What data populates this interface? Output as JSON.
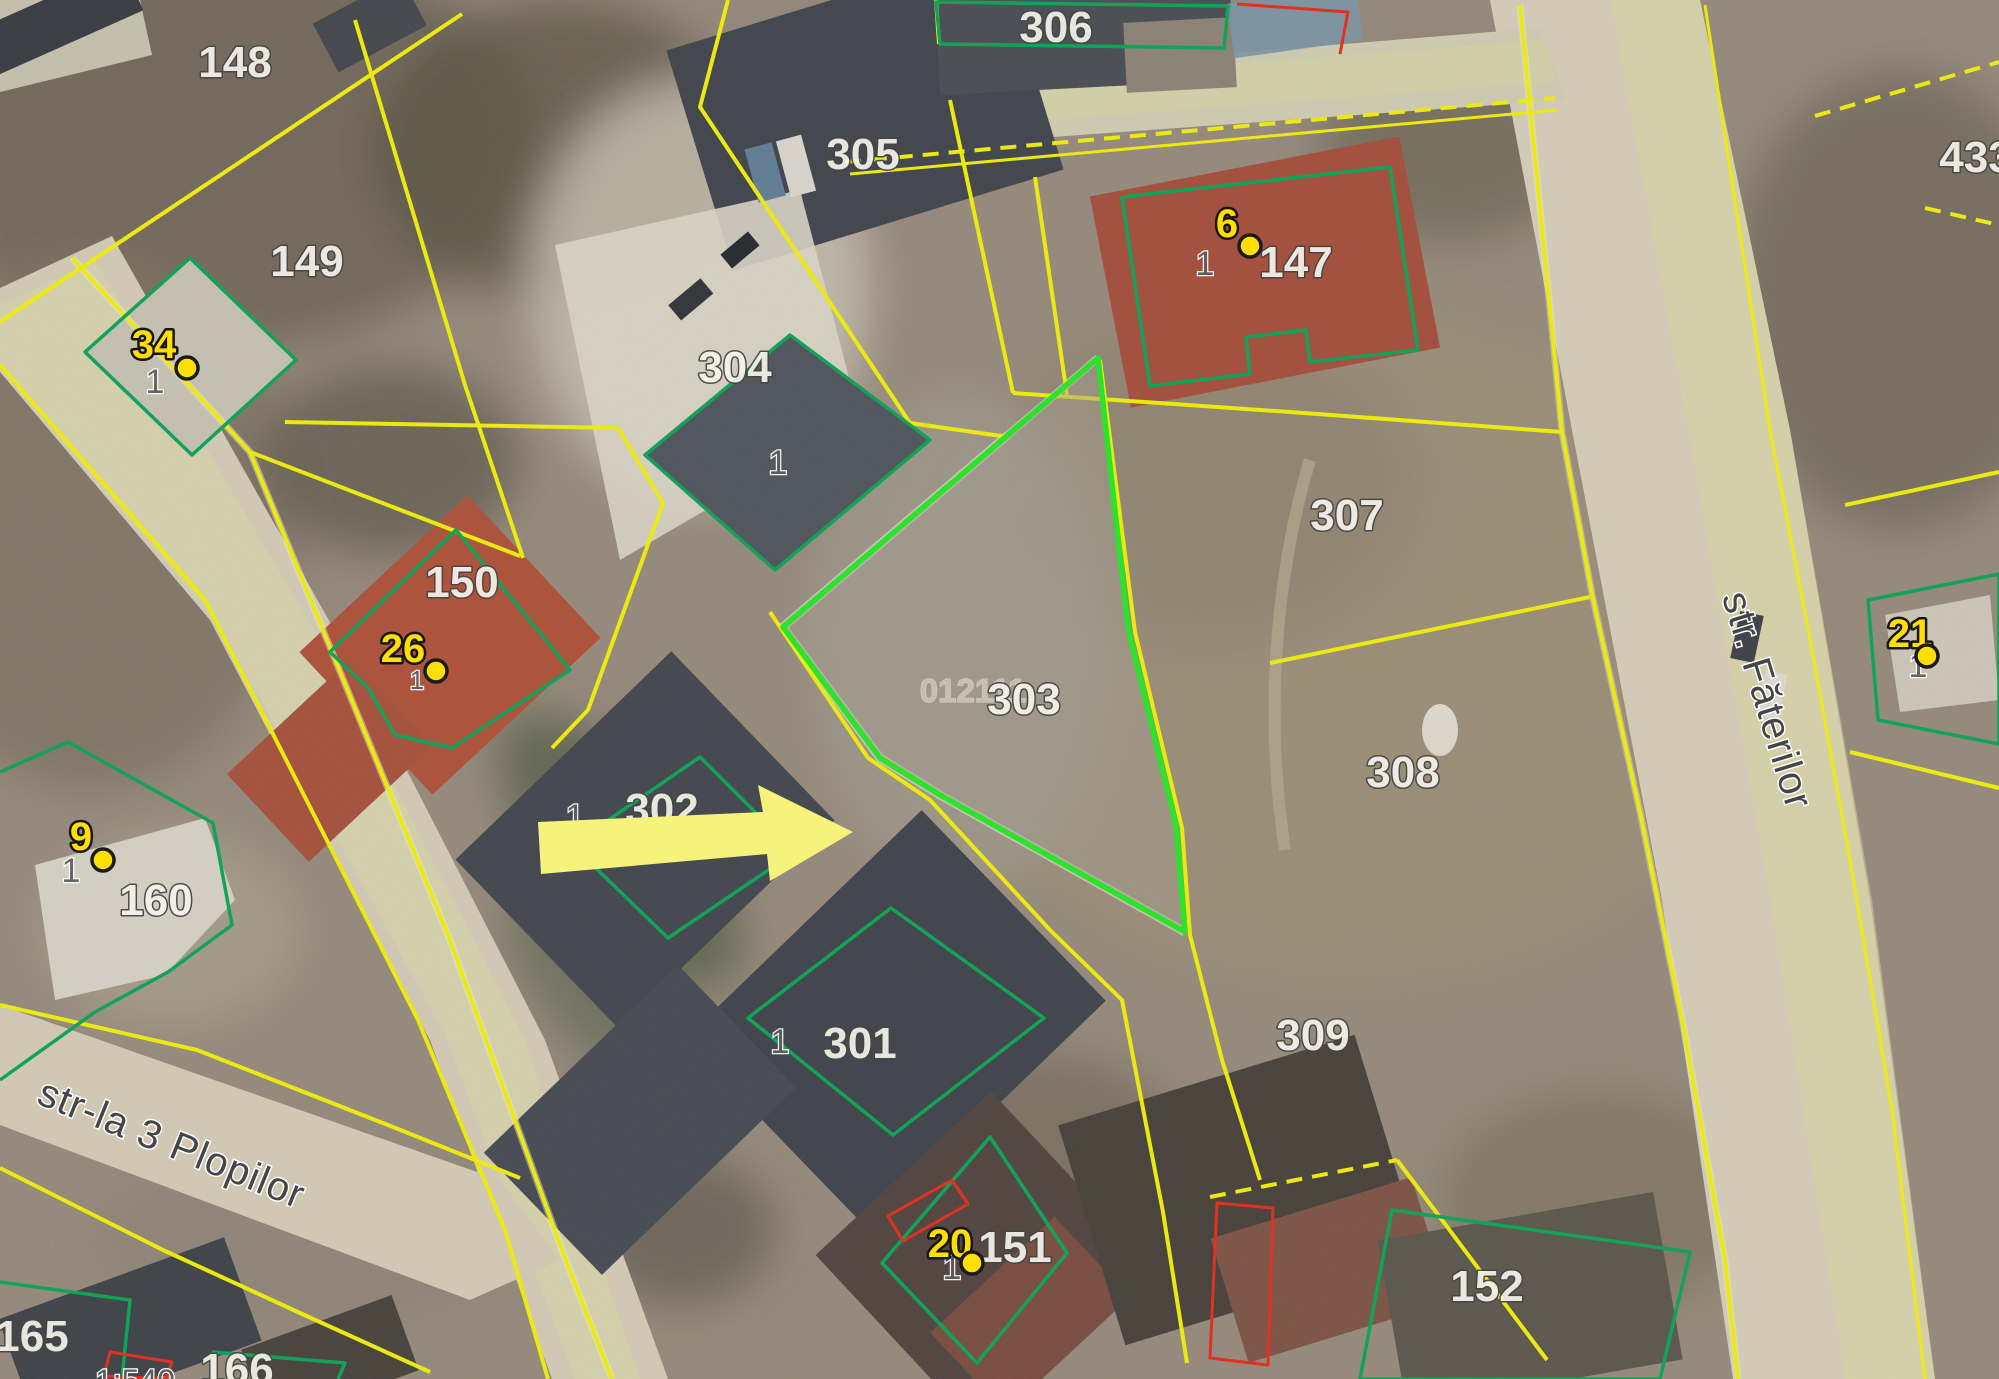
{
  "map": {
    "parcel_labels": [
      {
        "text": "148"
      },
      {
        "text": "149"
      },
      {
        "text": "305"
      },
      {
        "text": "304"
      },
      {
        "text": "306"
      },
      {
        "text": "147"
      },
      {
        "text": "303"
      },
      {
        "text": "307"
      },
      {
        "text": "308"
      },
      {
        "text": "150"
      },
      {
        "text": "302"
      },
      {
        "text": "160"
      },
      {
        "text": "301"
      },
      {
        "text": "309"
      },
      {
        "text": "151"
      },
      {
        "text": "152"
      },
      {
        "text": "165"
      },
      {
        "text": "166"
      },
      {
        "text": "433"
      }
    ],
    "cadastral_code": {
      "text": "012111"
    },
    "building_labels": [
      {
        "text": "1"
      },
      {
        "text": "1"
      },
      {
        "text": "1"
      },
      {
        "text": "1"
      },
      {
        "text": "1"
      },
      {
        "text": "1"
      },
      {
        "text": "1"
      },
      {
        "text": "1"
      },
      {
        "text": "1"
      }
    ],
    "address_badges": [
      {
        "number": "34"
      },
      {
        "number": "26"
      },
      {
        "number": "9"
      },
      {
        "number": "6"
      },
      {
        "number": "20"
      },
      {
        "number": "21"
      }
    ],
    "streets": [
      {
        "name": "str-la 3 Plopilor"
      },
      {
        "name": "str. Făterilor"
      }
    ],
    "scale_label": {
      "text": "1:540"
    }
  },
  "colors": {
    "parcel_boundary_yellow": "#EAEA12",
    "building_outline_green": "#12A35B",
    "selected_parcel_green": "#2BE32B",
    "restriction_red": "#E03222",
    "badge_yellow": "#FFDF00",
    "arrow_yellow": "#F7F27B"
  }
}
